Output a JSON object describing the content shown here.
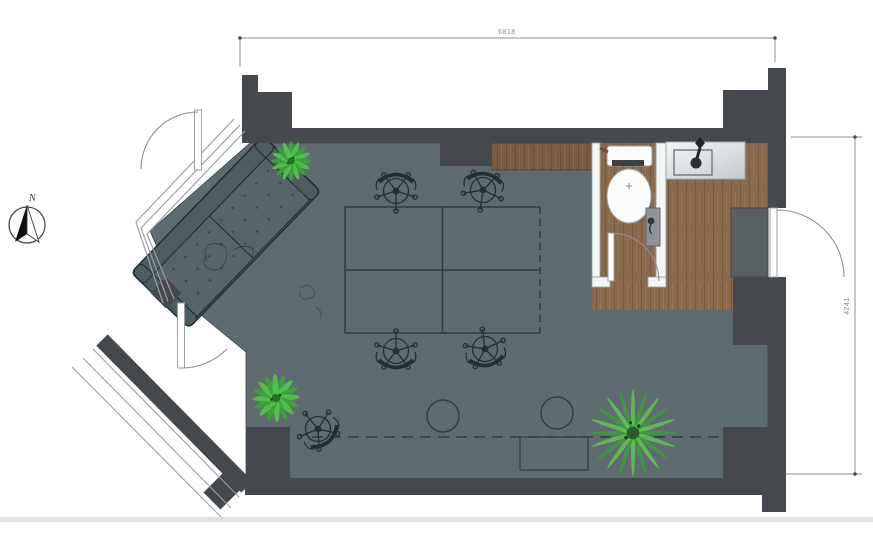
{
  "title": "studio-floor-plan",
  "dimensions": {
    "width_label": "6818",
    "height_label": "4241"
  },
  "compass": {
    "north_label": "N"
  },
  "colors": {
    "wall": "#45484d",
    "floor": "#5e6c6f",
    "wood": "#8a6a4c",
    "counter_wood": "#7b5c40",
    "sofa": "#4f5d61",
    "sofa_cushion": "#57656a",
    "mat": "#575f63",
    "plant_green": "#43b13f",
    "outline": "#2b3539",
    "dim_line": "#8f8f8f",
    "fixture_white": "#fafbfb"
  }
}
